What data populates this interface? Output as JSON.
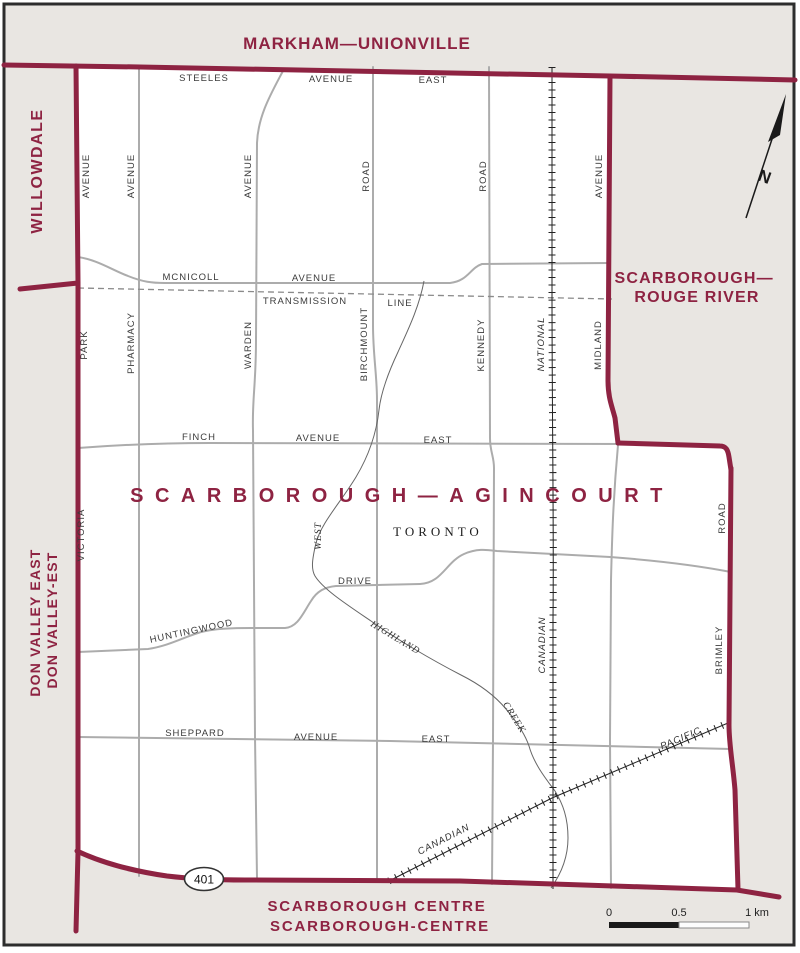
{
  "title_block": {
    "district": "SCARBOROUGH—AGINCOURT",
    "city": "TORONTO"
  },
  "neighbors": {
    "north": "MARKHAM—UNIONVILLE",
    "west_upper": "WILLOWDALE",
    "west_lower_line1": "DON VALLEY EAST",
    "west_lower_line2": "DON VALLEY-EST",
    "east_line1": "SCARBOROUGH—",
    "east_line2": "ROUGE RIVER",
    "south_line1": "SCARBOROUGH CENTRE",
    "south_line2": "SCARBOROUGH-CENTRE"
  },
  "roads": {
    "steeles": [
      "STEELES",
      "AVENUE",
      "EAST"
    ],
    "mcnicoll": [
      "MCNICOLL",
      "AVENUE"
    ],
    "transmission": [
      "TRANSMISSION",
      "LINE"
    ],
    "finch": [
      "FINCH",
      "AVENUE",
      "EAST"
    ],
    "huntingwood": [
      "HUNTINGWOOD",
      "DRIVE"
    ],
    "sheppard": [
      "SHEPPARD",
      "AVENUE",
      "EAST"
    ],
    "victoria_park": [
      "VICTORIA",
      "PARK",
      "AVENUE"
    ],
    "pharmacy": [
      "PHARMACY",
      "AVENUE"
    ],
    "warden": [
      "WARDEN",
      "AVENUE"
    ],
    "birchmount": [
      "BIRCHMOUNT",
      "ROAD"
    ],
    "kennedy": [
      "KENNEDY",
      "ROAD"
    ],
    "midland": [
      "MIDLAND",
      "AVENUE"
    ],
    "brimley": [
      "BRIMLEY",
      "ROAD"
    ],
    "highway": "401"
  },
  "railways": {
    "cn": [
      "CANADIAN",
      "NATIONAL"
    ],
    "cp": [
      "CANADIAN",
      "PACIFIC"
    ]
  },
  "creek": [
    "WEST",
    "HIGHLAND",
    "CREEK"
  ],
  "compass": "N",
  "scalebar": {
    "start": "0",
    "mid": "0.5",
    "end": "1 km"
  },
  "colors": {
    "boundary": "#8e2342",
    "road": "#acacac",
    "outside": "#e9e6e2",
    "railway": "#222222",
    "frame": "#2d2d2d"
  }
}
